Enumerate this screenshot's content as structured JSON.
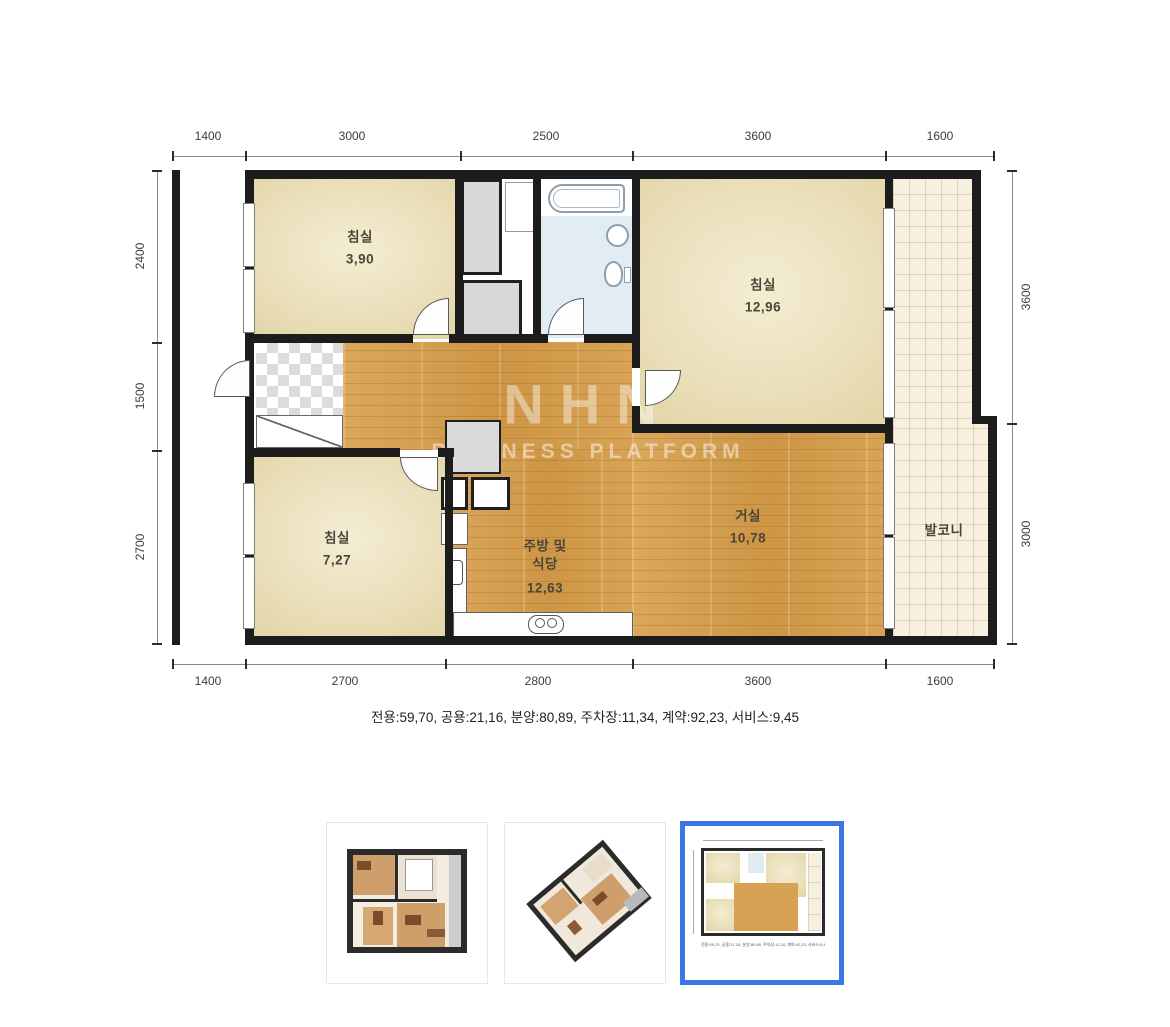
{
  "plan": {
    "rooms": {
      "bedroom_top_left": {
        "label": "침실",
        "area": "3,90"
      },
      "bedroom_top_right": {
        "label": "침실",
        "area": "12,96"
      },
      "bedroom_bottom_left": {
        "label": "침실",
        "area": "7,27"
      },
      "living_room": {
        "label": "거실",
        "area": "10,78"
      },
      "kitchen": {
        "label_line1": "주방 및",
        "label_line2": "식당",
        "area": "12,63"
      },
      "balcony": {
        "label": "발코니"
      }
    },
    "dimensions": {
      "top": [
        "1400",
        "3000",
        "2500",
        "3600",
        "1600"
      ],
      "bottom": [
        "1400",
        "2700",
        "2800",
        "3600",
        "1600"
      ],
      "left": [
        "2400",
        "1500",
        "2700"
      ],
      "right": [
        "3600",
        "3000"
      ]
    },
    "watermark": {
      "line1": "NHN",
      "line2": "BUSINESS PLATFORM"
    },
    "summary": "전용:59,70, 공용:21,16, 분양:80,89, 주차장:11,34, 계약:92,23, 서비스:9,45"
  },
  "thumbnails": {
    "items": [
      {
        "name": "3d-top-view",
        "selected": false
      },
      {
        "name": "3d-isometric-view",
        "selected": false
      },
      {
        "name": "2d-plan-view",
        "selected": true
      }
    ],
    "selected_border_color": "#3b76e6"
  },
  "colors": {
    "wall": "#1c1c1c",
    "room_beige": "#eadfba",
    "wood_floor": "#d7a053",
    "bathroom_floor": "#e2edf3",
    "balcony_tile": "#f8f0df",
    "dimension_text": "#3c3c3c"
  }
}
